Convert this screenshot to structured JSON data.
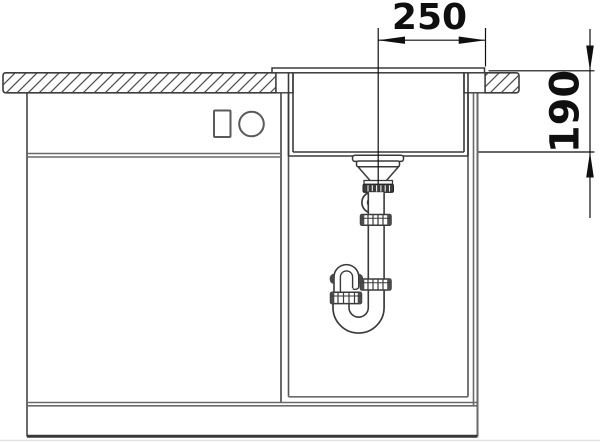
{
  "diagram": {
    "type": "technical-installation-drawing",
    "subject": "sink with drain siphon installed in base cabinet, sectional front view",
    "dimension_top_label": "250",
    "dimension_right_label": "190"
  },
  "colors": {
    "background": "#ffffff",
    "drawing_line": "#3a3a3a",
    "cabinet_line": "#6a6a6a",
    "dimension_ink": "#0f0f0f",
    "fitting_dark": "#3a3a3a",
    "hatch_line": "#4a4a4a"
  }
}
